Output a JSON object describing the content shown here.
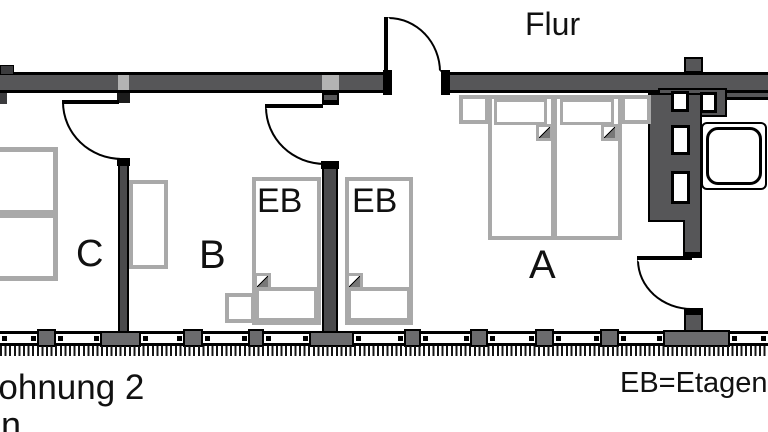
{
  "plan": {
    "hallway_label": "Flur",
    "room_a": "A",
    "room_b": "B",
    "room_c": "C",
    "eb": "EB",
    "apartment_label": "Wohnung 2",
    "apartment_label_line2": "n",
    "legend": "EB=Etagenbett",
    "colors": {
      "wall_fill": "#565658",
      "wall_edge": "#000000",
      "furniture_outline": "#a9a9a9",
      "background": "#ffffff"
    }
  }
}
